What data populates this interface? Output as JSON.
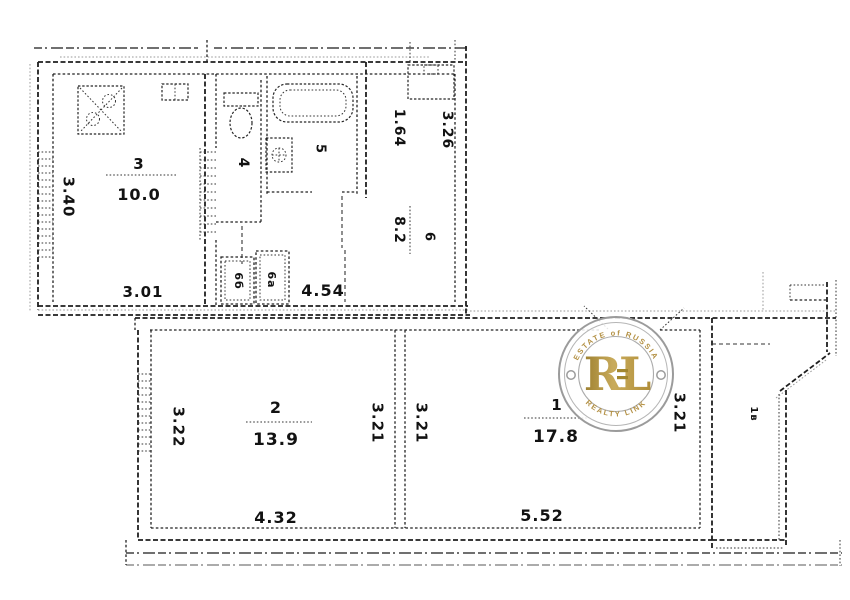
{
  "plan": {
    "ink": "#1f1f1f",
    "rooms": {
      "r1": {
        "number": "1",
        "area": "17.8"
      },
      "r2": {
        "number": "2",
        "area": "13.9"
      },
      "r3": {
        "number": "3",
        "area": "10.0"
      },
      "r4": {
        "number": "4"
      },
      "r5": {
        "number": "5"
      },
      "r6": {
        "number": "6",
        "area": "8.2"
      },
      "closet_left": {
        "number": "6б"
      },
      "closet_right": {
        "number": "6а"
      },
      "balcony": {
        "number": "1в"
      }
    },
    "dimensions": {
      "kitchen_width": "3.40",
      "kitchen_bottom": "3.01",
      "hall_top": "1.64",
      "upper_right": "3.26",
      "closet_row": "4.54",
      "room2_left": "3.22",
      "room2_bottom": "4.32",
      "room2_right": "3.21",
      "room1_left": "3.21",
      "room1_bottom": "5.52",
      "room1_right": "3.21"
    }
  },
  "watermark": {
    "arc_top": "ESTATE of RUSSIA",
    "monogram": "RL",
    "arc_bottom": "REALTY LINK",
    "gold": "#b39043",
    "ring": "#9b9b9b"
  }
}
